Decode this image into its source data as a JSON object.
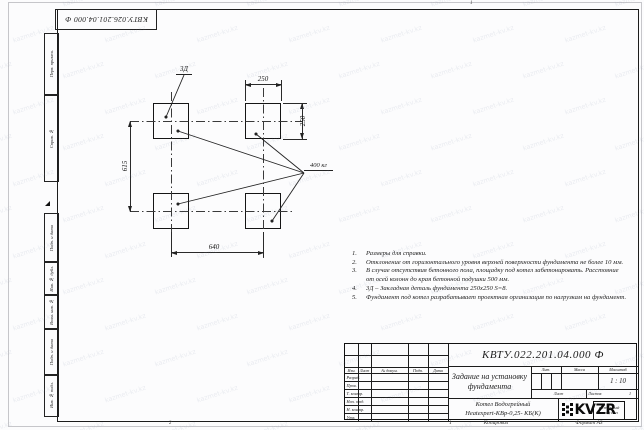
{
  "watermark": {
    "text": "kazmet-kv.kz"
  },
  "frame": {
    "top_stamp_number": "КВТУ.026.201.04.000 Ф",
    "zone_top": "1",
    "zone_bottom": "2"
  },
  "side_stamps": {
    "items": [
      {
        "label": "Перв. примен."
      },
      {
        "label": "Справ. №"
      },
      {
        "label": "Подп. и дата"
      },
      {
        "label": "Инв. № дубл."
      },
      {
        "label": "Взам. инв. №"
      },
      {
        "label": "Подп. и дата"
      },
      {
        "label": "Инв. № подл."
      }
    ]
  },
  "drawing": {
    "embed_label": "3Д",
    "load_label": "400 кг",
    "dims": {
      "top_width": "250",
      "right_height": "250",
      "left_height": "615",
      "bottom_width": "640"
    }
  },
  "notes": {
    "items": [
      {
        "num": "1.",
        "text": "Размеры для справки."
      },
      {
        "num": "2.",
        "text": "Отклонение от горизонтального уровня верхней поверхности фундамента не более 10 мм."
      },
      {
        "num": "3.",
        "text": "В случае отсутствия бетонного пола, площадку под котел забетонировать. Расстояние от осей колонн до края бетонной подушки 500 мм."
      },
      {
        "num": "4.",
        "text": "3Д – Закладная деталь фундамента 250х250 S=8."
      },
      {
        "num": "5.",
        "text": "Фундамент под котел разрабатывает проектная организация по нагрузкам на фундамент."
      }
    ]
  },
  "title_block": {
    "doc_number": "КВТУ.022.201.04.000 Ф",
    "title": "Задание на установку фундамента",
    "header": {
      "izm": "Изм.",
      "list": "Лист",
      "doc": "№ докум.",
      "podp": "Подп.",
      "data": "Дата"
    },
    "rows": [
      {
        "label": "Разраб."
      },
      {
        "label": "Пров."
      },
      {
        "label": "Т. контр."
      },
      {
        "label": "Нач. отд."
      },
      {
        "label": "Н. контр."
      },
      {
        "label": "Утв."
      }
    ],
    "lit_label": "Лит.",
    "mass_label": "Масса",
    "scale_label": "Масштаб",
    "scale_value": "1 : 10",
    "sheet_label": "Лист",
    "sheets_label": "Листов",
    "sheets_value": "1",
    "product_line1": "Котел Водогрейный",
    "product_line2": "Heatexpert-КВр-0,25- КБ(К)",
    "logo_text": "KVZR",
    "logo_sub1": "КОТЕЛЬНЫЙ",
    "logo_sub2": "ЗАВОД РЭП"
  },
  "footer": {
    "sheet_mark": "1",
    "copied_label": "Копировал",
    "format_label": "Формат А3"
  }
}
